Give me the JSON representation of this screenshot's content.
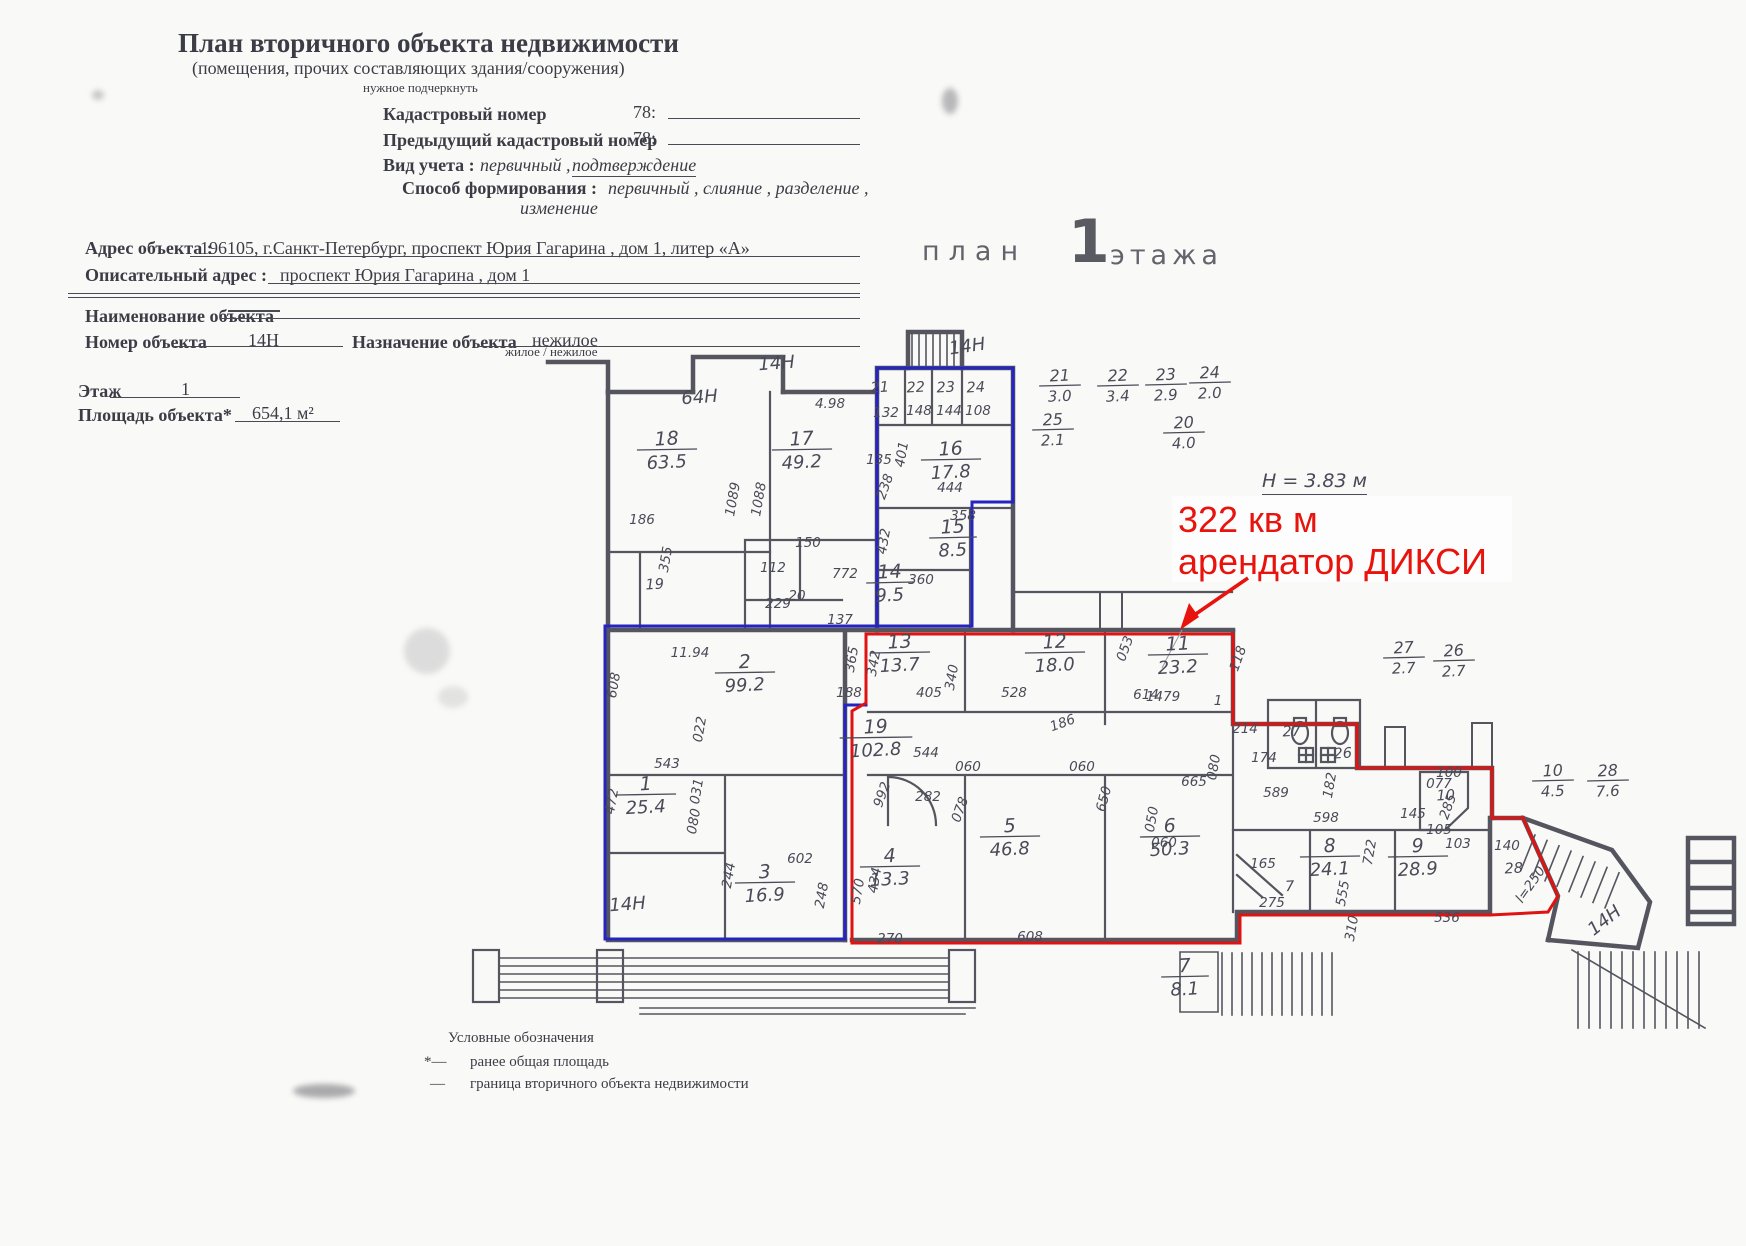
{
  "form": {
    "title": "План вторичного объекта недвижимости",
    "subtitle": "(помещения, прочих составляющих здания/сооружения)",
    "subtitle_note": "нужное подчеркнуть",
    "cadastral_label": "Кадастровый номер",
    "cadastral_prefix": "78:",
    "prev_cadastral_label": "Предыдущий кадастровый номер",
    "prev_cadastral_prefix": "78:",
    "vid_label": "Вид учета :",
    "vid_value": "первичный ,",
    "vid_value2": "подтверждение",
    "sposob_label": "Способ формирования :",
    "sposob_value": "первичный , слияние , разделение ,",
    "sposob_value2": "изменение",
    "address_label": "Адрес объекта :",
    "address_value": "196105, г.Санкт-Петербург, проспект Юрия Гагарина , дом 1, литер «А»",
    "descr_label": "Описательный адрес :",
    "descr_value": "проспект Юрия Гагарина , дом 1",
    "name_label": "Наименование объекта",
    "number_label": "Номер объекта",
    "number_value": "14Н",
    "purpose_label": "Назначение объекта",
    "purpose_value": "нежилое",
    "purpose_note": "жилое / нежилое",
    "floor_label": "Этаж",
    "floor_value": "1",
    "area_label": "Площадь объекта*",
    "area_value": "654,1 м²"
  },
  "plan_header": {
    "word_plan": "план",
    "floor_number": "1",
    "word_floor": "этажа"
  },
  "annotation": {
    "line1": "322 кв м",
    "line2": "арендатор ДИКСИ"
  },
  "height_note": "Н = 3.83 м",
  "legend": {
    "title": "Условные обозначения",
    "marker1": "*—",
    "item1": "ранее общая площадь",
    "marker2": "—",
    "item2": "граница вторичного объекта недвижимости"
  },
  "colors": {
    "boundary_blue": "#2424c0",
    "boundary_red": "#e01212",
    "walls": "#55555f",
    "annotation_red": "#e8130c"
  },
  "plan": {
    "rooms": [
      {
        "n": "18",
        "a": "63.5",
        "x": 667,
        "y": 445
      },
      {
        "n": "17",
        "a": "49.2",
        "x": 802,
        "y": 445
      },
      {
        "n": "16",
        "a": "17.8",
        "x": 951,
        "y": 455
      },
      {
        "n": "15",
        "a": "8.5",
        "x": 953,
        "y": 533
      },
      {
        "n": "14",
        "a": "9.5",
        "x": 890,
        "y": 578
      },
      {
        "n": "2",
        "a": "99.2",
        "x": 745,
        "y": 668
      },
      {
        "n": "13",
        "a": "13.7",
        "x": 900,
        "y": 648
      },
      {
        "n": "12",
        "a": "18.0",
        "x": 1055,
        "y": 648
      },
      {
        "n": "11",
        "a": "23.2",
        "x": 1178,
        "y": 650
      },
      {
        "n": "19",
        "a": "102.8",
        "x": 876,
        "y": 733
      },
      {
        "n": "1",
        "a": "25.4",
        "x": 646,
        "y": 790
      },
      {
        "n": "3",
        "a": "16.9",
        "x": 765,
        "y": 878
      },
      {
        "n": "4",
        "a": "13.3",
        "x": 890,
        "y": 862
      },
      {
        "n": "5",
        "a": "46.8",
        "x": 1010,
        "y": 832
      },
      {
        "n": "6",
        "a": "50.3",
        "x": 1170,
        "y": 832
      },
      {
        "n": "8",
        "a": "24.1",
        "x": 1330,
        "y": 852
      },
      {
        "n": "9",
        "a": "28.9",
        "x": 1418,
        "y": 852
      },
      {
        "n": "7",
        "a": "8.1",
        "x": 1185,
        "y": 972
      }
    ],
    "fractions": [
      {
        "n": "21",
        "a": "3.0",
        "x": 1060,
        "y": 381
      },
      {
        "n": "22",
        "a": "3.4",
        "x": 1118,
        "y": 381
      },
      {
        "n": "23",
        "a": "2.9",
        "x": 1166,
        "y": 380
      },
      {
        "n": "24",
        "a": "2.0",
        "x": 1210,
        "y": 378
      },
      {
        "n": "25",
        "a": "2.1",
        "x": 1053,
        "y": 425
      },
      {
        "n": "20",
        "a": "4.0",
        "x": 1184,
        "y": 428
      },
      {
        "n": "27",
        "a": "2.7",
        "x": 1404,
        "y": 653
      },
      {
        "n": "26",
        "a": "2.7",
        "x": 1454,
        "y": 656
      },
      {
        "n": "10",
        "a": "4.5",
        "x": 1553,
        "y": 776
      },
      {
        "n": "28",
        "a": "7.6",
        "x": 1608,
        "y": 776
      }
    ],
    "unit_labels": [
      {
        "t": "64Н",
        "x": 700,
        "y": 403,
        "r": -4
      },
      {
        "t": "14Н",
        "x": 777,
        "y": 369,
        "r": -4
      },
      {
        "t": "14Н",
        "x": 968,
        "y": 352,
        "r": -8
      },
      {
        "t": "14Н",
        "x": 628,
        "y": 910,
        "r": -4
      },
      {
        "t": "14Н",
        "x": 1608,
        "y": 925,
        "r": -38
      }
    ],
    "small_labels": [
      {
        "t": "21",
        "x": 880,
        "y": 392
      },
      {
        "t": "22",
        "x": 916,
        "y": 392
      },
      {
        "t": "23",
        "x": 946,
        "y": 392
      },
      {
        "t": "24",
        "x": 976,
        "y": 392
      },
      {
        "t": "19",
        "x": 655,
        "y": 589
      },
      {
        "t": "7",
        "x": 1290,
        "y": 891
      },
      {
        "t": "10",
        "x": 1446,
        "y": 800
      },
      {
        "t": "27",
        "x": 1292,
        "y": 736
      },
      {
        "t": "26",
        "x": 1343,
        "y": 758
      },
      {
        "t": "28",
        "x": 1514,
        "y": 873
      }
    ],
    "dims": [
      {
        "t": "4.98",
        "x": 830,
        "y": 408
      },
      {
        "t": "1089",
        "x": 737,
        "y": 500,
        "r": -80
      },
      {
        "t": "1088",
        "x": 763,
        "y": 500,
        "r": -80
      },
      {
        "t": "186",
        "x": 642,
        "y": 524
      },
      {
        "t": "355",
        "x": 670,
        "y": 560,
        "r": -80
      },
      {
        "t": "150",
        "x": 808,
        "y": 547
      },
      {
        "t": "112",
        "x": 773,
        "y": 572
      },
      {
        "t": "20",
        "x": 797,
        "y": 600
      },
      {
        "t": "229",
        "x": 778,
        "y": 608
      },
      {
        "t": "772",
        "x": 845,
        "y": 578
      },
      {
        "t": "432",
        "x": 888,
        "y": 542,
        "r": -80
      },
      {
        "t": "137",
        "x": 840,
        "y": 624
      },
      {
        "t": "360",
        "x": 921,
        "y": 584
      },
      {
        "t": "444",
        "x": 950,
        "y": 492
      },
      {
        "t": "358",
        "x": 963,
        "y": 520
      },
      {
        "t": "401",
        "x": 906,
        "y": 455,
        "r": -80
      },
      {
        "t": "135",
        "x": 879,
        "y": 464
      },
      {
        "t": "238",
        "x": 889,
        "y": 488,
        "r": -70
      },
      {
        "t": "132",
        "x": 886,
        "y": 417
      },
      {
        "t": "148",
        "x": 919,
        "y": 415
      },
      {
        "t": "144",
        "x": 949,
        "y": 415
      },
      {
        "t": "108",
        "x": 978,
        "y": 415
      },
      {
        "t": "11.94",
        "x": 690,
        "y": 657
      },
      {
        "t": "608",
        "x": 618,
        "y": 686,
        "r": -80
      },
      {
        "t": "543",
        "x": 667,
        "y": 768
      },
      {
        "t": "022",
        "x": 704,
        "y": 730,
        "r": -80
      },
      {
        "t": "031",
        "x": 701,
        "y": 792,
        "r": -80
      },
      {
        "t": "080",
        "x": 698,
        "y": 822,
        "r": -80
      },
      {
        "t": "472",
        "x": 616,
        "y": 802,
        "r": -80
      },
      {
        "t": "244",
        "x": 733,
        "y": 876,
        "r": -80
      },
      {
        "t": "602",
        "x": 800,
        "y": 863
      },
      {
        "t": "248",
        "x": 826,
        "y": 896,
        "r": -80
      },
      {
        "t": "270",
        "x": 890,
        "y": 943
      },
      {
        "t": "608",
        "x": 1030,
        "y": 941
      },
      {
        "t": "570",
        "x": 862,
        "y": 892,
        "r": -80
      },
      {
        "t": "434",
        "x": 879,
        "y": 881,
        "r": -80
      },
      {
        "t": "342",
        "x": 878,
        "y": 664,
        "r": -80
      },
      {
        "t": "365",
        "x": 856,
        "y": 660,
        "r": -80
      },
      {
        "t": "188",
        "x": 849,
        "y": 697
      },
      {
        "t": "405",
        "x": 929,
        "y": 697
      },
      {
        "t": "340",
        "x": 956,
        "y": 678,
        "r": -80
      },
      {
        "t": "528",
        "x": 1014,
        "y": 697
      },
      {
        "t": "186",
        "x": 1064,
        "y": 727,
        "r": -20
      },
      {
        "t": "1479",
        "x": 1163,
        "y": 701
      },
      {
        "t": "1",
        "x": 1218,
        "y": 705
      },
      {
        "t": "614",
        "x": 1146,
        "y": 699
      },
      {
        "t": "053",
        "x": 1129,
        "y": 650,
        "r": -70
      },
      {
        "t": "118",
        "x": 1242,
        "y": 660,
        "r": -70
      },
      {
        "t": "214",
        "x": 1245,
        "y": 733
      },
      {
        "t": "174",
        "x": 1264,
        "y": 762
      },
      {
        "t": "665",
        "x": 1194,
        "y": 786
      },
      {
        "t": "080",
        "x": 1218,
        "y": 768,
        "r": -80
      },
      {
        "t": "589",
        "x": 1276,
        "y": 797
      },
      {
        "t": "598",
        "x": 1326,
        "y": 822
      },
      {
        "t": "182",
        "x": 1334,
        "y": 786,
        "r": -80
      },
      {
        "t": "050",
        "x": 1156,
        "y": 820,
        "r": -80
      },
      {
        "t": "060",
        "x": 1164,
        "y": 847
      },
      {
        "t": "060",
        "x": 968,
        "y": 771
      },
      {
        "t": "060",
        "x": 1082,
        "y": 771
      },
      {
        "t": "078",
        "x": 964,
        "y": 811,
        "r": -70
      },
      {
        "t": "282",
        "x": 928,
        "y": 801
      },
      {
        "t": "992",
        "x": 886,
        "y": 796,
        "r": -70
      },
      {
        "t": "544",
        "x": 926,
        "y": 757
      },
      {
        "t": "650",
        "x": 1108,
        "y": 800,
        "r": -75
      },
      {
        "t": "165",
        "x": 1263,
        "y": 868
      },
      {
        "t": "722",
        "x": 1374,
        "y": 853,
        "r": -80
      },
      {
        "t": "555",
        "x": 1347,
        "y": 894,
        "r": -80
      },
      {
        "t": "275",
        "x": 1272,
        "y": 907
      },
      {
        "t": "310",
        "x": 1356,
        "y": 929,
        "r": -80
      },
      {
        "t": "536",
        "x": 1447,
        "y": 922
      },
      {
        "t": "100",
        "x": 1449,
        "y": 777
      },
      {
        "t": "077",
        "x": 1439,
        "y": 788
      },
      {
        "t": "145",
        "x": 1413,
        "y": 818
      },
      {
        "t": "105",
        "x": 1439,
        "y": 834
      },
      {
        "t": "103",
        "x": 1458,
        "y": 848
      },
      {
        "t": "285",
        "x": 1452,
        "y": 808,
        "r": -70
      },
      {
        "t": "140",
        "x": 1507,
        "y": 850
      },
      {
        "t": "l=250",
        "x": 1534,
        "y": 887,
        "r": -55
      }
    ]
  }
}
